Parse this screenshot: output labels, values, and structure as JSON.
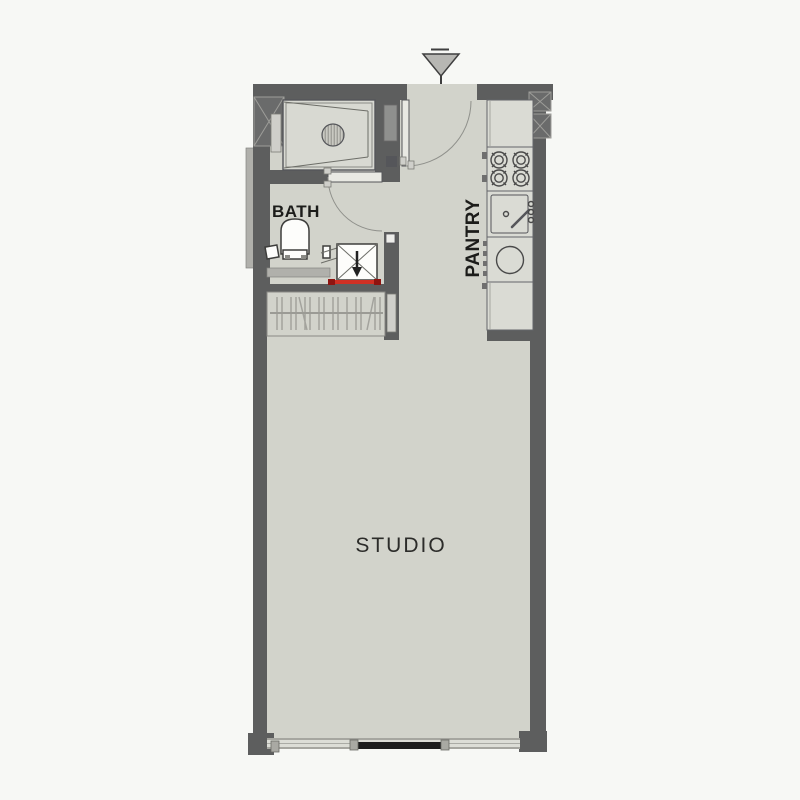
{
  "floorplan": {
    "rooms": {
      "bath": {
        "label": "BATH"
      },
      "pantry": {
        "label": "PANTRY"
      },
      "studio": {
        "label": "STUDIO"
      }
    },
    "symbols": [
      "entrance-marker-icon",
      "entrance-door-swing",
      "bath-door-swing",
      "shower-drain-icon",
      "toilet-icon",
      "toilet-paper-holder-icon",
      "washer-box-icon",
      "washer-alert-line",
      "wardrobe-hanger-rail-icon",
      "stove-4-burner-icon",
      "kitchen-sink-icon",
      "washing-machine-icon",
      "base-cabinet",
      "sliding-window-door",
      "structural-column-hatch"
    ]
  },
  "colors": {
    "page-bg": "#f7f8f5",
    "floor": "#d2d3cb",
    "shower-floor": "#d8d9d2",
    "wall": "#5d5e5e",
    "wall-light": "#b0b0ab",
    "column-fill": "#6a6b6b",
    "hatch-line": "#9d9d99",
    "fixture-fill": "#fdfdfb",
    "counter-fill": "#dadbd4",
    "door-leaf": "#e9e9e3",
    "door-arc": "#8f908b",
    "accent-red": "#d03024",
    "accent-red-dark": "#8e1410",
    "slider-dark": "#1d1d1d",
    "marker-fill": "#b7b7b3",
    "label-color": "#1c1c1a"
  }
}
